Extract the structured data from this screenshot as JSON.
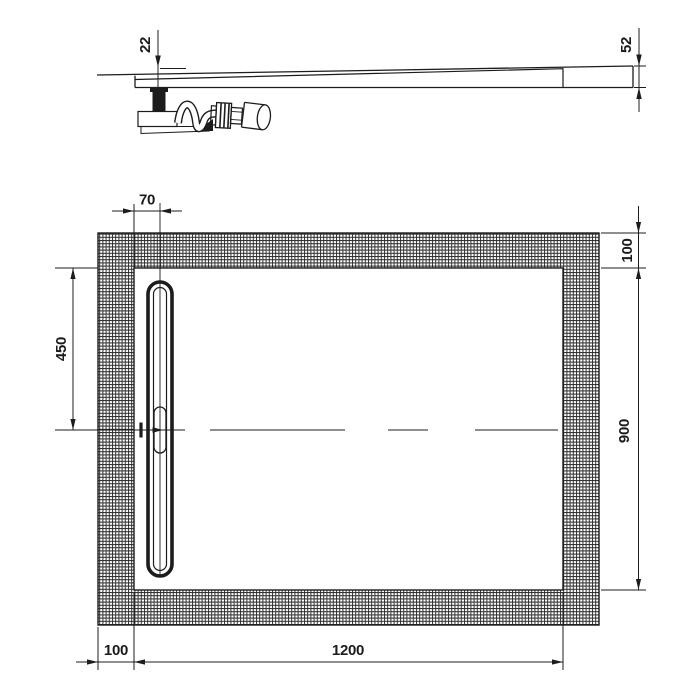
{
  "drawing": {
    "type": "technical-drawing",
    "subject": "rectangular shower tray with linear drain - section and plan views",
    "ink_color": "#1c1c1c",
    "bg_color": "#ffffff"
  },
  "side_view": {
    "drain_depth_label": "22",
    "edge_height_label": "52"
  },
  "plan_view": {
    "drain_offset_label": "70",
    "drain_center_from_top_label": "450",
    "top_border_label": "100",
    "inner_height_label": "900",
    "left_border_label": "100",
    "inner_width_label": "1200"
  }
}
